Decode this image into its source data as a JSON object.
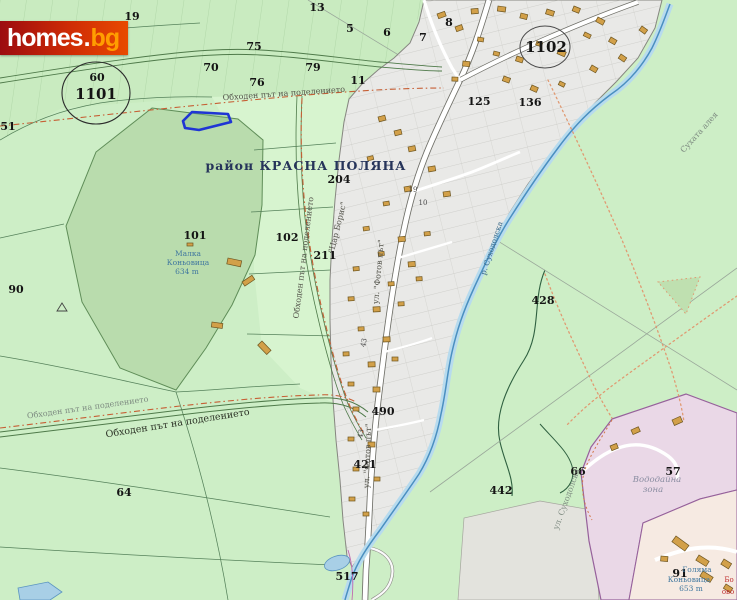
{
  "site": {
    "logo_homes": "homes",
    "logo_dot": ".",
    "logo_bg": "bg"
  },
  "district": {
    "name": "район КРАСНА ПОЛЯНА"
  },
  "zones": {
    "circle_left": "1101",
    "circle_right": "1102"
  },
  "parcels": {
    "n5": "5",
    "n6": "6",
    "n7": "7",
    "n8": "8",
    "n10": "10",
    "n11": "11",
    "n13": "13",
    "n19": "19",
    "n43": "43",
    "n51": "51",
    "n57": "57",
    "n60": "60",
    "n64": "64",
    "n66": "66",
    "n70": "70",
    "n75": "75",
    "n76": "76",
    "n79": "79",
    "n90": "90",
    "n91": "91",
    "n101": "101",
    "n102": "102",
    "n125": "125",
    "n136": "136",
    "n204": "204",
    "n211": "211",
    "n421": "421",
    "n428": "428",
    "n442": "442",
    "n490": "490",
    "n517": "517"
  },
  "roads": {
    "obhoden": "Обходен път на поделението",
    "tsar_boris": "\"Цар Борис\"",
    "fotov": "ул. \"Фотов път\"",
    "suhodolska": "ул. Суходолска",
    "suhata_aleya": "Сухата алея"
  },
  "water": {
    "river": "р. Суходолска"
  },
  "places": {
    "malka_name1": "Малка",
    "malka_name2": "Коньовица",
    "malka_elev": "634 m",
    "golyama_name1": "Голяма",
    "golyama_name2": "Коньовица",
    "golyama_elev": "653 m",
    "vododayna1": "Вододайна",
    "vododayna2": "зона",
    "red_a": "Бо",
    "red_b": "ово"
  },
  "colors": {
    "highlight_parcel": "#1f35d4",
    "field_green": "#cdeec6",
    "urban_gray": "#e9e9e7",
    "water_blue": "#4a8fc0",
    "zone_pink": "#ead8e7",
    "logo_red": "#c01808"
  }
}
